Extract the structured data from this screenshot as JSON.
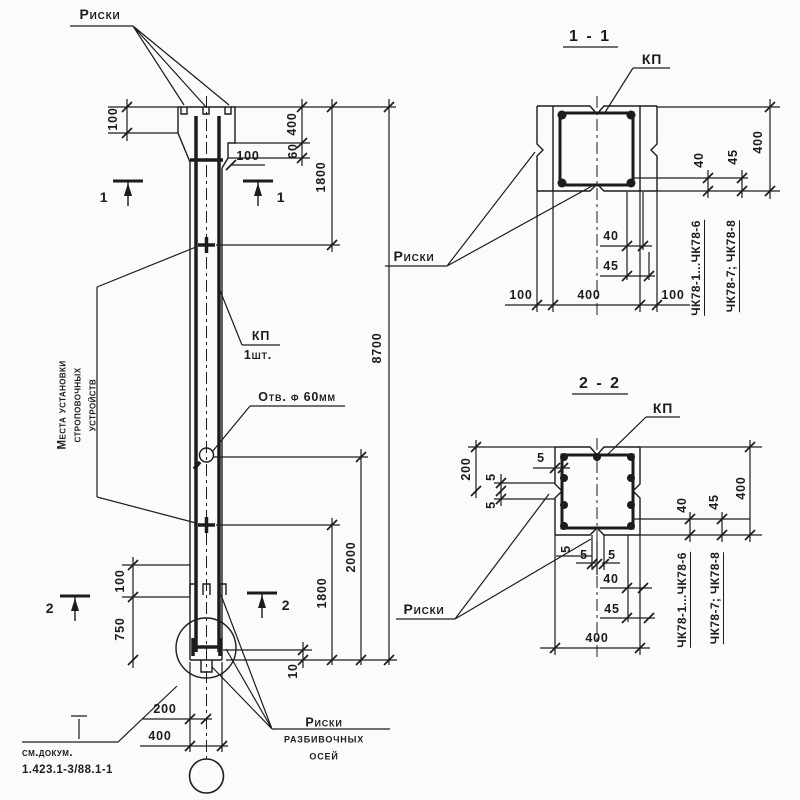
{
  "texts": {
    "riski": "Риски",
    "razb1": "Риски",
    "razb2": "разбивочных",
    "razb3": "осей",
    "mesta1": "Места установки",
    "mesta2": "строповочных",
    "mesta3": "устройств",
    "kp": "КП",
    "kp_qty": "1шт.",
    "otv": "Отв. ф 60мм",
    "see_doc1": "см.докум.",
    "see_doc2": "1.423.1-3/88.1-1",
    "sec1_title": "1 - 1",
    "sec2_title": "2 - 2",
    "cut1": "1",
    "cut2": "2",
    "chk_a": "ЧК78-1...ЧК78-6",
    "chk_b": "ЧК78-7; ЧК78-8"
  },
  "dims": {
    "v5": "5",
    "v10": "10",
    "v40": "40",
    "v45": "45",
    "v60": "60",
    "v100": "100",
    "v200": "200",
    "v400": "400",
    "v750": "750",
    "v1800": "1800",
    "v2000": "2000",
    "v8700": "8700"
  },
  "colors": {
    "ink": "#1c1c1c",
    "paper": "#fbfbf9"
  }
}
